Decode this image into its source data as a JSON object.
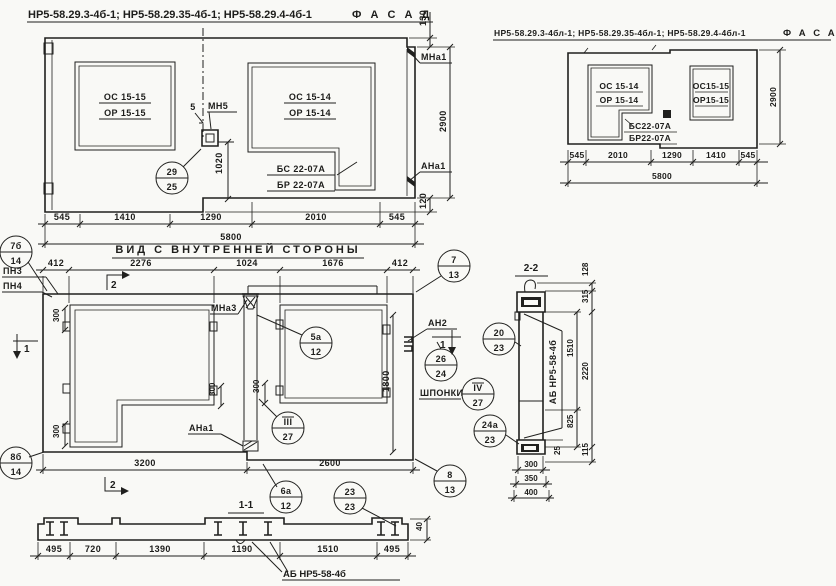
{
  "page": {
    "background": "#f9f9f6",
    "ink": "#20201e"
  },
  "facade_left": {
    "title": "НР5-58.29.3-4б-1; НР5-58.29.35-4б-1; НР5-58.29.4-4б-1",
    "fasad": "Ф А С А Д",
    "win1_top": "ОС 15-15",
    "win1_bot": "ОР 15-15",
    "win2_top": "ОС 15-14",
    "win2_bot": "ОР 15-14",
    "corner_top": "БС 22-07А",
    "corner_bot": "БР 22-07А",
    "mn5": "МН5",
    "dim5": "5",
    "mna1": "МНа1",
    "ana1": "АНа1",
    "dims": [
      "545",
      "1410",
      "1290",
      "2010",
      "545"
    ],
    "total": "5800",
    "d130": "130",
    "d2900": "2900",
    "d120": "120",
    "d1020": "1020"
  },
  "facade_right": {
    "title": "НР5-58.29.3-4бл-1; НР5-58.29.35-4бл-1; НР5-58.29.4-4бл-1",
    "fasad": "Ф А С А Д",
    "win1_top": "ОС 15-14",
    "win1_bot": "ОР 15-14",
    "corner_top": "БС22-07А",
    "corner_bot": "БР22-07А",
    "win2_top": "ОС15-15",
    "win2_bot": "ОР15-15",
    "dims": [
      "545",
      "2010",
      "1290",
      "1410",
      "545"
    ],
    "total": "5800",
    "d2900": "2900"
  },
  "inner_view": {
    "title": "ВИД С ВНУТРЕННЕЙ СТОРОНЫ",
    "pn3": "ПН3",
    "pn4": "ПН4",
    "mna3": "МНа3",
    "ana1": "АНа1",
    "an2": "АН2",
    "shponki": "ШПОНКИ",
    "marker1": "1",
    "marker2": "2",
    "dims_top": [
      "412",
      "2276",
      "1024",
      "1676",
      "412"
    ],
    "dim_3200": "3200",
    "dim_2600": "2600",
    "d300": "300",
    "d1800": "1800",
    "callouts": {
      "c29": {
        "top": "29",
        "bot": "25"
      },
      "c7b": {
        "top": "7б",
        "bot": "14"
      },
      "c8b": {
        "top": "8б",
        "bot": "14"
      },
      "c5a": {
        "top": "5а",
        "bot": "12"
      },
      "c6a": {
        "top": "6а",
        "bot": "12"
      },
      "c7": {
        "top": "7",
        "bot": "13"
      },
      "c8": {
        "top": "8",
        "bot": "13"
      },
      "c26": {
        "top": "26",
        "bot": "24"
      },
      "c3": {
        "top": "III",
        "bot": "27"
      },
      "c4": {
        "top": "IV",
        "bot": "27"
      },
      "c20": {
        "top": "20",
        "bot": "23"
      },
      "c24a": {
        "top": "24а",
        "bot": "23"
      },
      "c23": {
        "top": "23",
        "bot": "23"
      }
    }
  },
  "section_11": {
    "title": "1-1",
    "dims": [
      "495",
      "720",
      "1390",
      "1190",
      "1510",
      "495"
    ],
    "d40": "40",
    "ab_label": "АБ НР5-58-4б"
  },
  "section_22": {
    "title": "2-2",
    "ab_label": "АБ НР5-58-4б",
    "d128": "128",
    "d315": "315",
    "d1510": "1510",
    "d2220": "2220",
    "d825": "825",
    "d25": "25",
    "d115": "115",
    "d300": "300",
    "d350": "350",
    "d400": "400"
  }
}
